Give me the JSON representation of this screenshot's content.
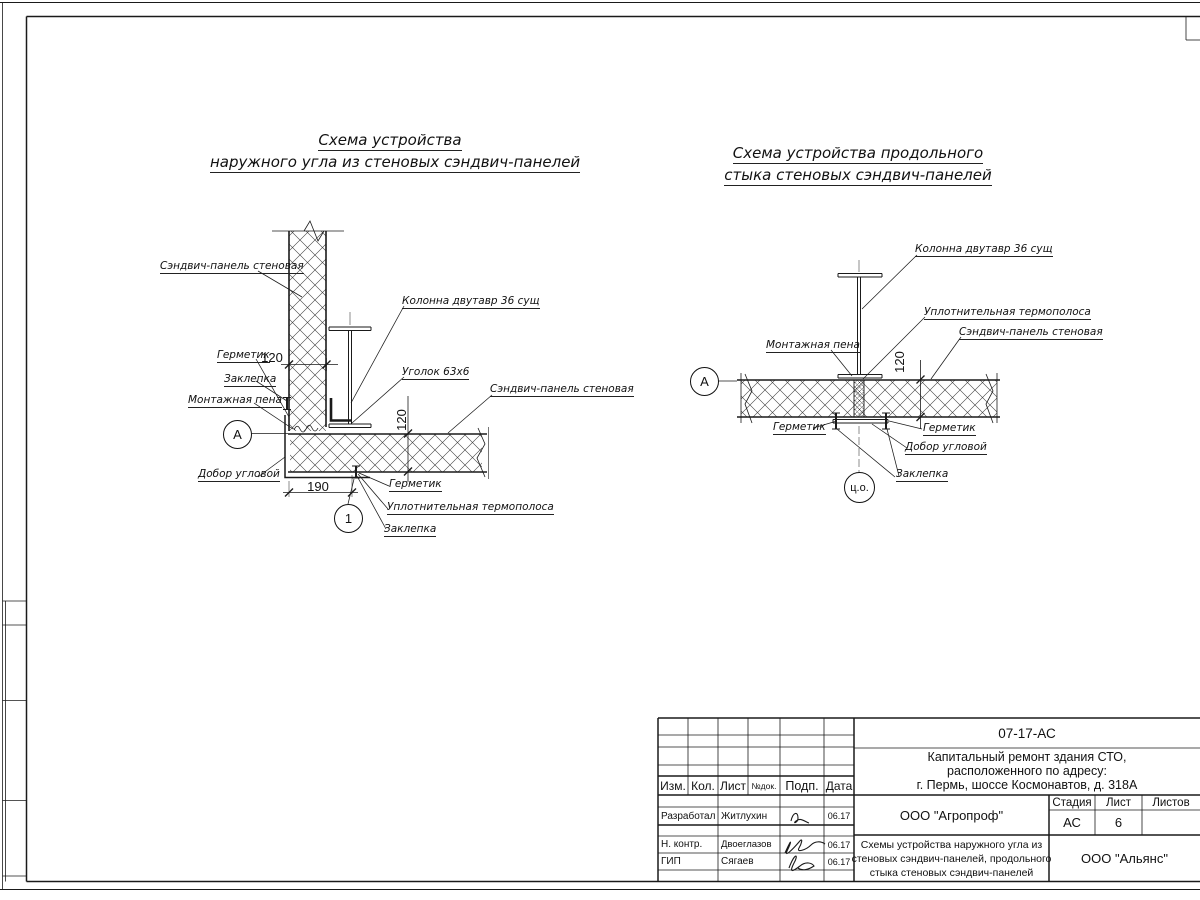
{
  "diagram_left": {
    "title1": "Схема устройства",
    "title2": "наружного угла из стеновых сэндвич-панелей",
    "lbl_panel": "Сэндвич-панель стеновая",
    "lbl_column": "Колонна двутавр 36 сущ",
    "lbl_sealant_top": "Герметик",
    "lbl_rivet_top": "Заклепка",
    "lbl_foam": "Монтажная пена",
    "lbl_angle": "Уголок 63х6",
    "lbl_panel2": "Сэндвич-панель стеновая",
    "lbl_trim": "Добор угловой",
    "lbl_sealant_bot": "Герметик",
    "lbl_thermo": "Уплотнительная термополоса",
    "lbl_rivet_bot": "Заклепка",
    "dim_120h": "120",
    "dim_120v": "120",
    "dim_190": "190",
    "marker_axis": "А",
    "marker_detail": "1"
  },
  "diagram_right": {
    "title1": "Схема устройства продольного",
    "title2": "стыка стеновых сэндвич-панелей",
    "lbl_column": "Колонна двутавр 36 сущ",
    "lbl_thermo": "Уплотнительная термополоса",
    "lbl_panel": "Сэндвич-панель стеновая",
    "lbl_foam": "Монтажная пена",
    "lbl_sealant_left": "Герметик",
    "lbl_sealant_right": "Герметик",
    "lbl_trim": "Добор угловой",
    "lbl_rivet": "Заклепка",
    "dim_120v": "120",
    "marker_axis": "А",
    "marker_center": "ц.о."
  },
  "title_block": {
    "doc_number": "07-17-АС",
    "project_line1": "Капитальный ремонт здания СТО,",
    "project_line2": "расположенного по адресу:",
    "project_line3": "г. Пермь, шоссе Космонавтов, д. 318А",
    "col_izm": "Изм.",
    "col_kol": "Кол.",
    "col_list": "Лист",
    "col_ndok": "№док.",
    "col_podp": "Подп.",
    "col_data": "Дата",
    "row1_role": "Разработал",
    "row1_name": "Житлухин",
    "row1_date": "06.17",
    "row2_role": "Н. контр.",
    "row2_name": "Двоеглазов",
    "row2_date": "06.17",
    "row3_role": "ГИП",
    "row3_name": "Сягаев",
    "row3_date": "06.17",
    "org_designer": "ООО \"Агропроф\"",
    "stage_label": "Стадия",
    "sheet_label": "Лист",
    "sheets_label": "Листов",
    "stage_value": "АС",
    "sheet_value": "6",
    "sheet_title1": "Схемы устройства наружного угла из",
    "sheet_title2": "стеновых сэндвич-панелей, продольного",
    "sheet_title3": "стыка стеновых сэндвич-панелей",
    "org_customer": "ООО \"Альянс\""
  }
}
